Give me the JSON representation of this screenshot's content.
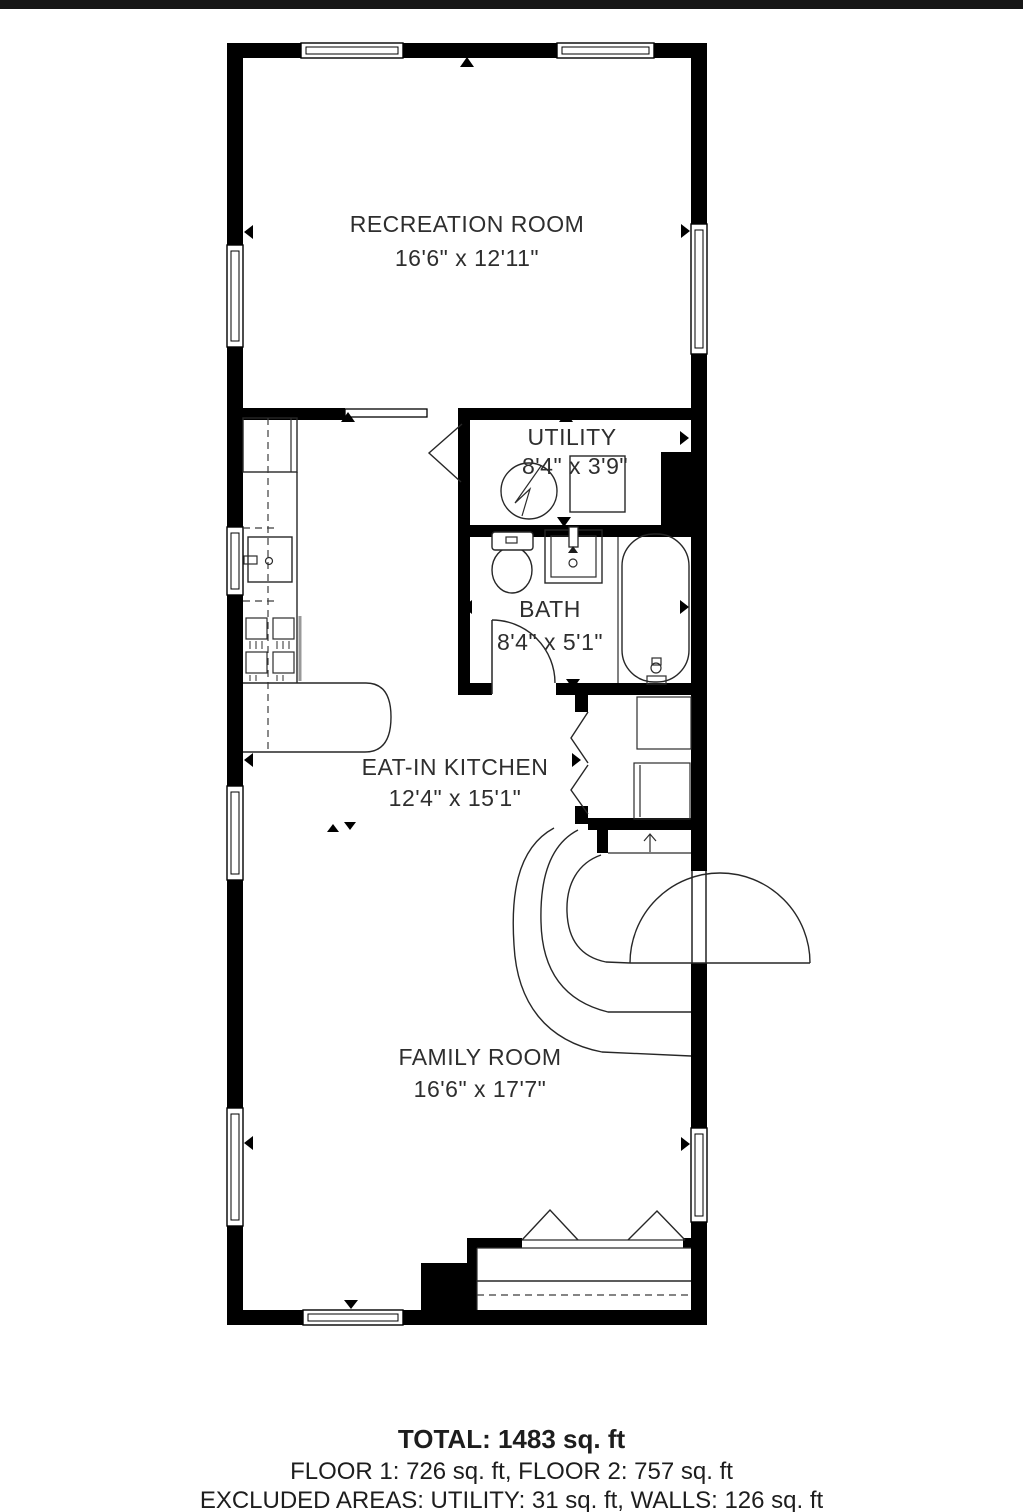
{
  "plan": {
    "type": "floor-plan",
    "rooms": [
      {
        "id": "recreation",
        "name": "RECREATION ROOM",
        "dimensions": "16'6\" x 12'11\""
      },
      {
        "id": "utility",
        "name": "UTILITY",
        "dimensions": "8'4\" x 3'9\""
      },
      {
        "id": "bath",
        "name": "BATH",
        "dimensions": "8'4\" x 5'1\""
      },
      {
        "id": "kitchen",
        "name": "EAT-IN KITCHEN",
        "dimensions": "12'4\" x 15'1\""
      },
      {
        "id": "family",
        "name": "FAMILY ROOM",
        "dimensions": "16'6\" x 17'7\""
      }
    ],
    "fixtures": [
      "water-heater",
      "furnace",
      "toilet",
      "vanity-sink",
      "bathtub",
      "kitchen-sink",
      "stove",
      "kitchen-peninsula",
      "closet-shelves",
      "curved-staircase",
      "entry-door",
      "pocket-door",
      "bifold-doors",
      "porch"
    ],
    "colors": {
      "wall": "#000000",
      "text": "#2e2e2e",
      "background": "#ffffff",
      "top_bar": "#161616"
    }
  },
  "summary": {
    "total": "TOTAL: 1483 sq. ft",
    "floors": "FLOOR 1: 726 sq. ft, FLOOR 2: 757 sq. ft",
    "excluded": "EXCLUDED AREAS: UTILITY: 31 sq. ft, WALLS: 126 sq. ft"
  }
}
